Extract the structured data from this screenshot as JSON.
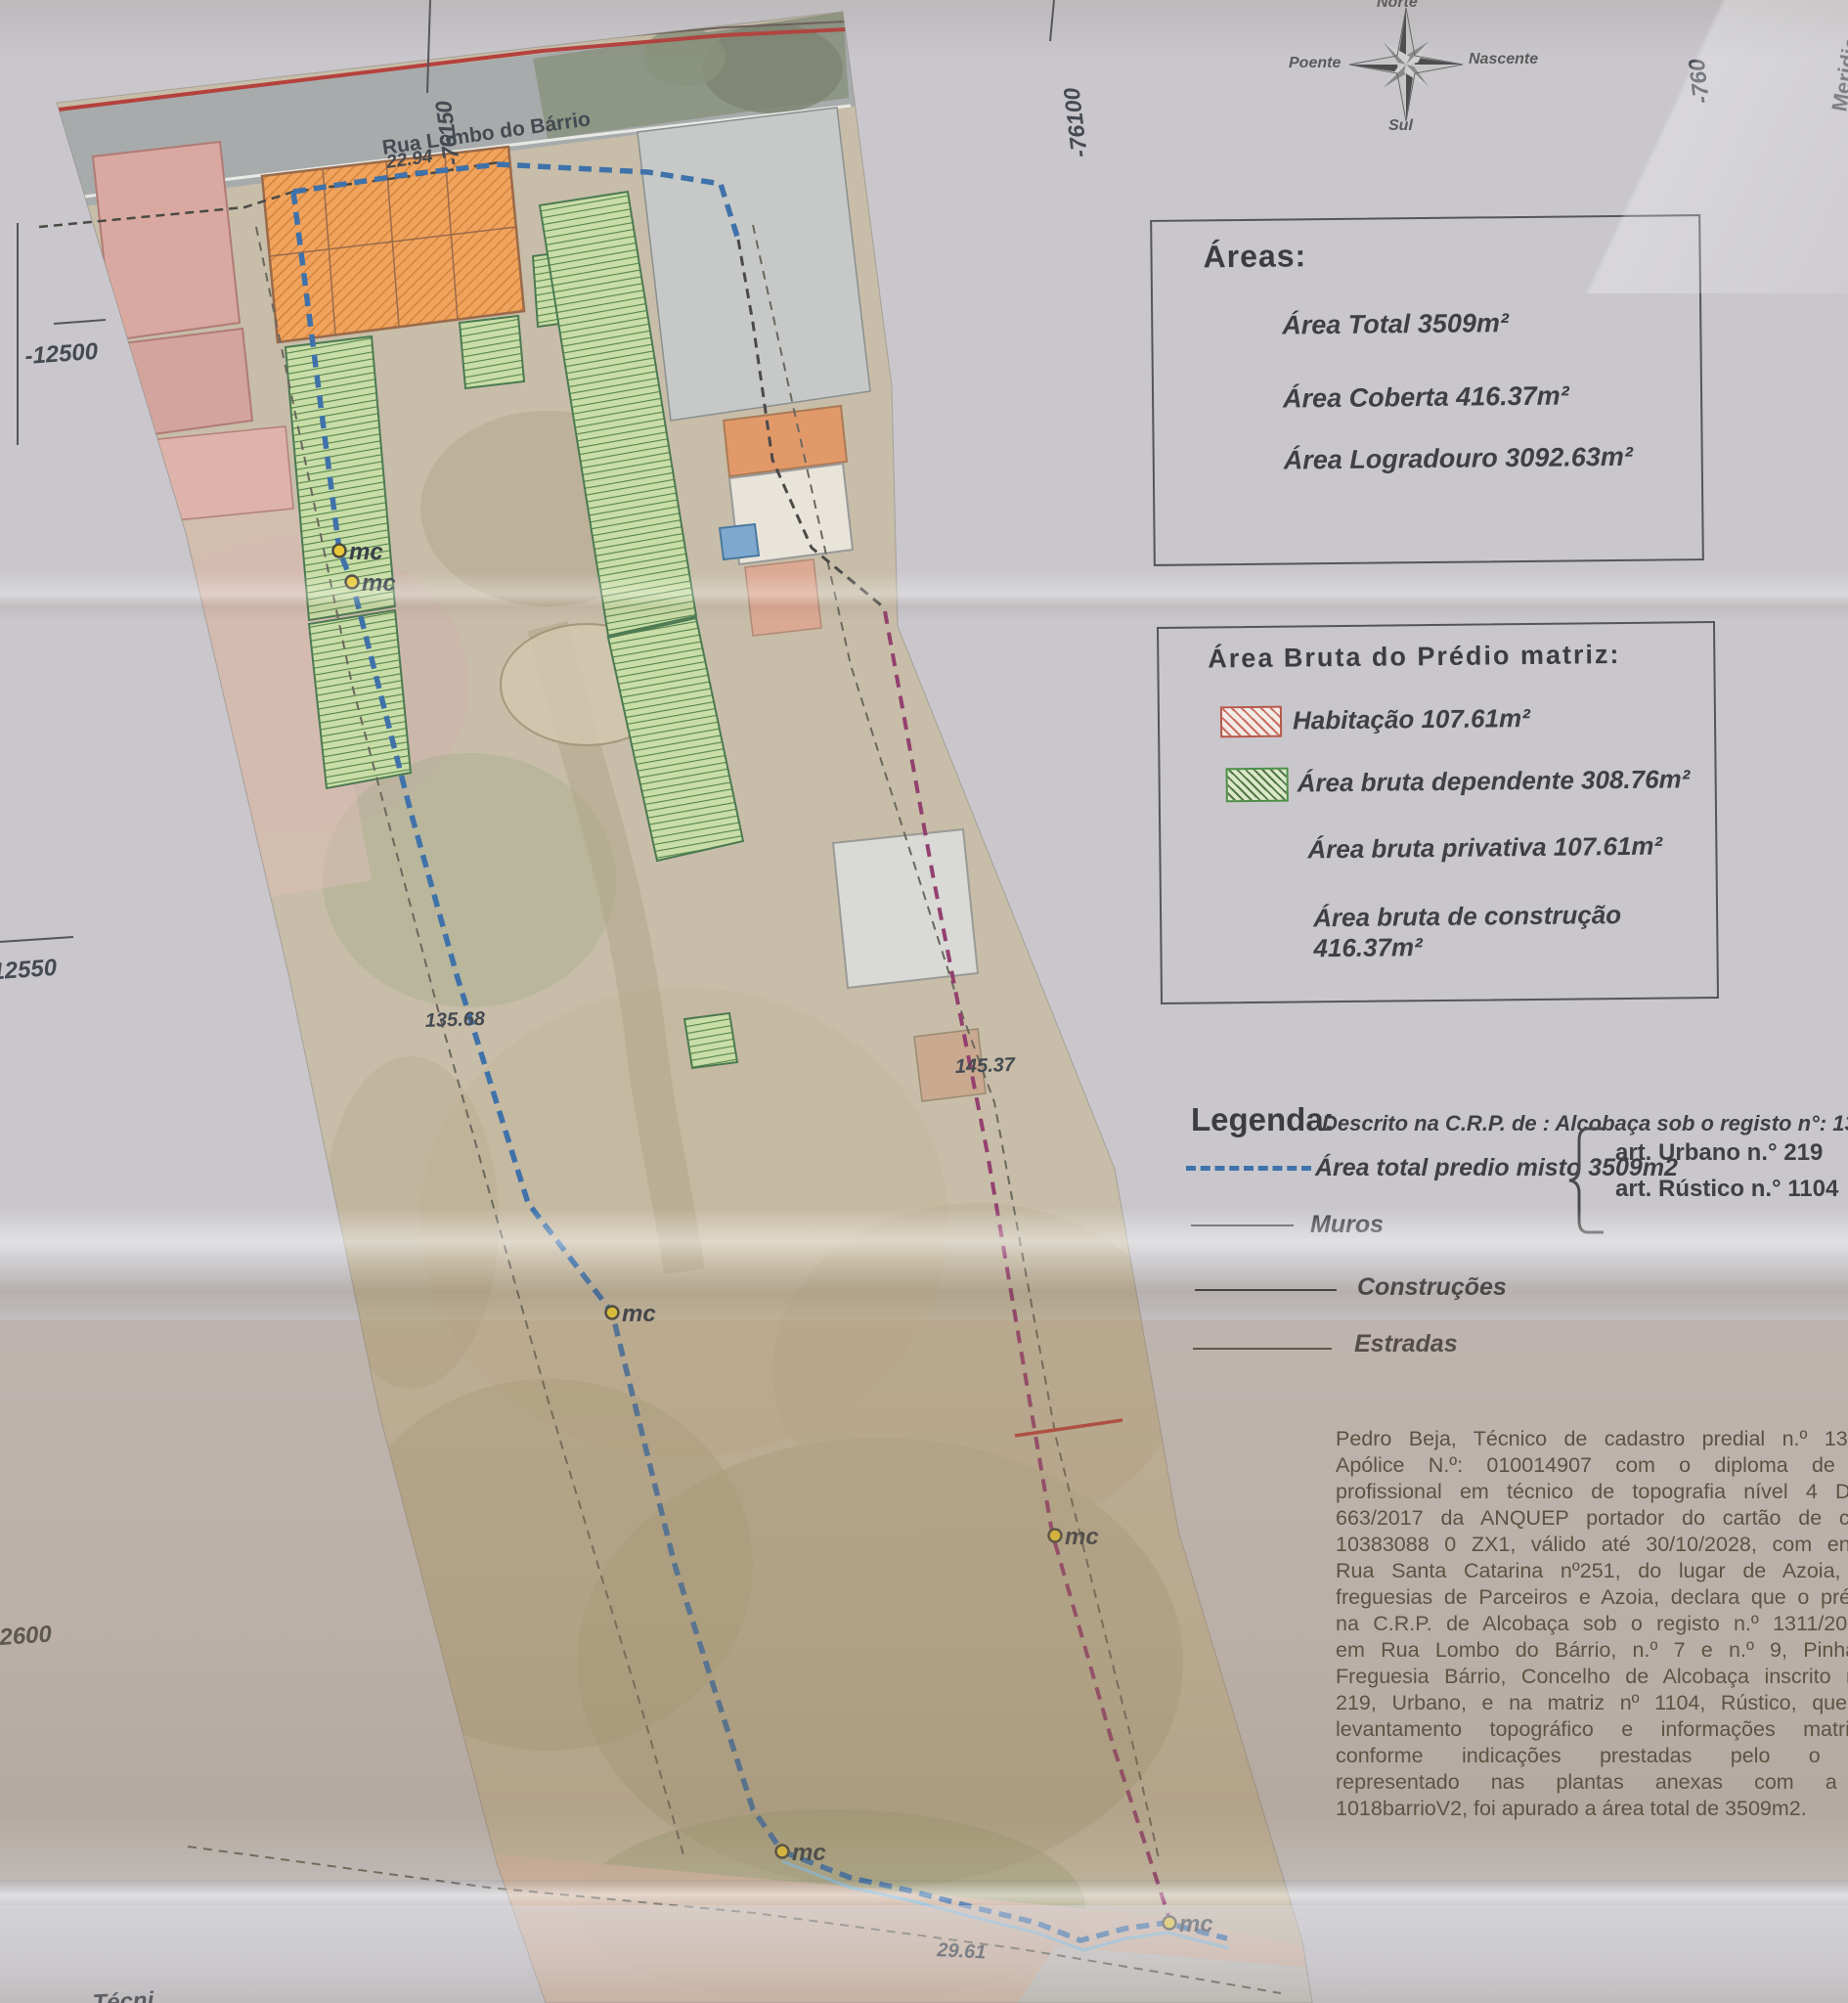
{
  "compass": {
    "north": "Norte",
    "south": "Sul",
    "east": "Nascente",
    "west": "Poente"
  },
  "areas_box": {
    "title": "Áreas:",
    "total": "Área Total 3509m²",
    "coberta": "Área  Coberta 416.37m²",
    "logradouro": "Área Logradouro 3092.63m²"
  },
  "bruta_box": {
    "title": "Área Bruta do Prédio matriz:",
    "habitacao": "Habitação 107.61m²",
    "dependente": "Área bruta dependente 308.76m²",
    "privativa": "Área bruta privativa 107.61m²",
    "construcao": "Área bruta de construção 416.37m²"
  },
  "legend": {
    "title": "Legenda:",
    "crp_line": "Descrito na C.R.P. de : Alcobaça sob o registo n°: 1311/2004",
    "total_line": "Área total predio misto 3509m2",
    "art_urbano": "art.  Urbano n.° 219",
    "art_rustico": "art.  Rústico n.° 1104",
    "muros": "Muros",
    "construcoes": "Construções",
    "estradas": "Estradas"
  },
  "declaration": {
    "lines": [
      "Pedro Beja, Técnico de cadastro predial n.º 13, topógra",
      "Apólice N.º: 010014907 com o diploma de certificaç",
      "profissional em técnico de topografia nível 4 Diploma n",
      "663/2017 da ANQUEP portador do cartão de cidadão n",
      "10383088 0 ZX1, válido até 30/10/2028, com endereço n",
      "Rua Santa Catarina nº251, do lugar de Azoia, União d",
      "freguesias de Parceiros e Azoia, declara que o prédio descr",
      "na C.R.P. de Alcobaça sob o registo n.º 1311/20040423 s",
      "em Rua Lombo do Bárrio, n.º 7 e n.º 9, Pinhal Fanhei",
      "Freguesia Bárrio, Concelho de Alcobaça inscrito na matriz",
      "219, Urbano, e na matriz nº 1104, Rústico,  que o prese",
      "levantamento topográfico e informações matriciais es",
      "conforme indicações prestadas pelo o proprietá",
      "representado nas plantas anexas com a designa",
      "1018barrioV2, foi apurado a área total de 3509m2."
    ]
  },
  "map": {
    "street": "Rua Lombo do Bárrio",
    "marker": "mc",
    "dimensions": {
      "top": "22.94",
      "left": "135.68",
      "right": "145.37",
      "bottom": "29.61"
    },
    "grid": {
      "top_left": "-76150",
      "top_mid": "-76100",
      "top_right": "-760",
      "left_upper": "-12500",
      "left_middle": "-12550",
      "left_lower": "2600",
      "right_edge": "Meridia"
    },
    "edge_fragment": "Técni"
  },
  "colors": {
    "boundary_blue": "#3f72aa",
    "boundary_magenta": "#93406f",
    "hatch_red": "#c4574a",
    "hatch_green": "#4e8f4a",
    "road_red": "#b5413d",
    "marker_yellow": "#e8c838"
  }
}
